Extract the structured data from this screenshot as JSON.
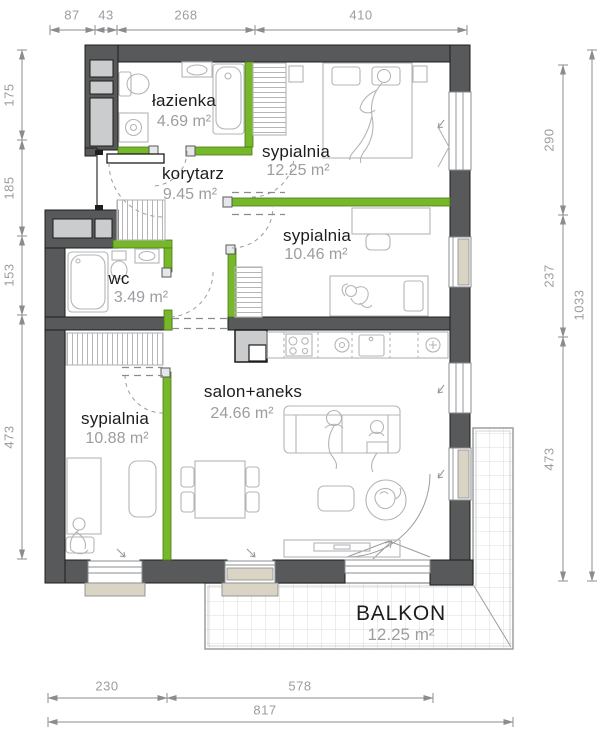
{
  "plan": {
    "rooms": [
      {
        "id": "lazienka",
        "name": "łazienka",
        "area": "4.69 m²"
      },
      {
        "id": "korytarz",
        "name": "korytarz",
        "area": "9.45 m²"
      },
      {
        "id": "sypialnia1",
        "name": "sypialnia",
        "area": "12.25 m²"
      },
      {
        "id": "sypialnia2",
        "name": "sypialnia",
        "area": "10.46 m²"
      },
      {
        "id": "wc",
        "name": "wc",
        "area": "3.49 m²"
      },
      {
        "id": "sypialnia3",
        "name": "sypialnia",
        "area": "10.88 m²"
      },
      {
        "id": "salon",
        "name": "salon+aneks",
        "area": "24.66 m²"
      },
      {
        "id": "balkon",
        "name": "BALKON",
        "area": "12.25 m²"
      }
    ],
    "dimensions": {
      "top": [
        "87",
        "43",
        "268",
        "410"
      ],
      "left": [
        "175",
        "185",
        "153",
        "473"
      ],
      "right_inner": [
        "290",
        "237",
        "473"
      ],
      "right_outer": [
        "1033"
      ],
      "bottom_inner": [
        "230",
        "578"
      ],
      "bottom_outer": [
        "817"
      ]
    },
    "colors": {
      "wall": "#58595b",
      "partition_green": "#76b82a",
      "window_beige": "#d9d4c3",
      "furniture_line": "#b3b5b7",
      "dim_gray": "#9b9da0",
      "room_text": "#1d1d1b"
    }
  }
}
